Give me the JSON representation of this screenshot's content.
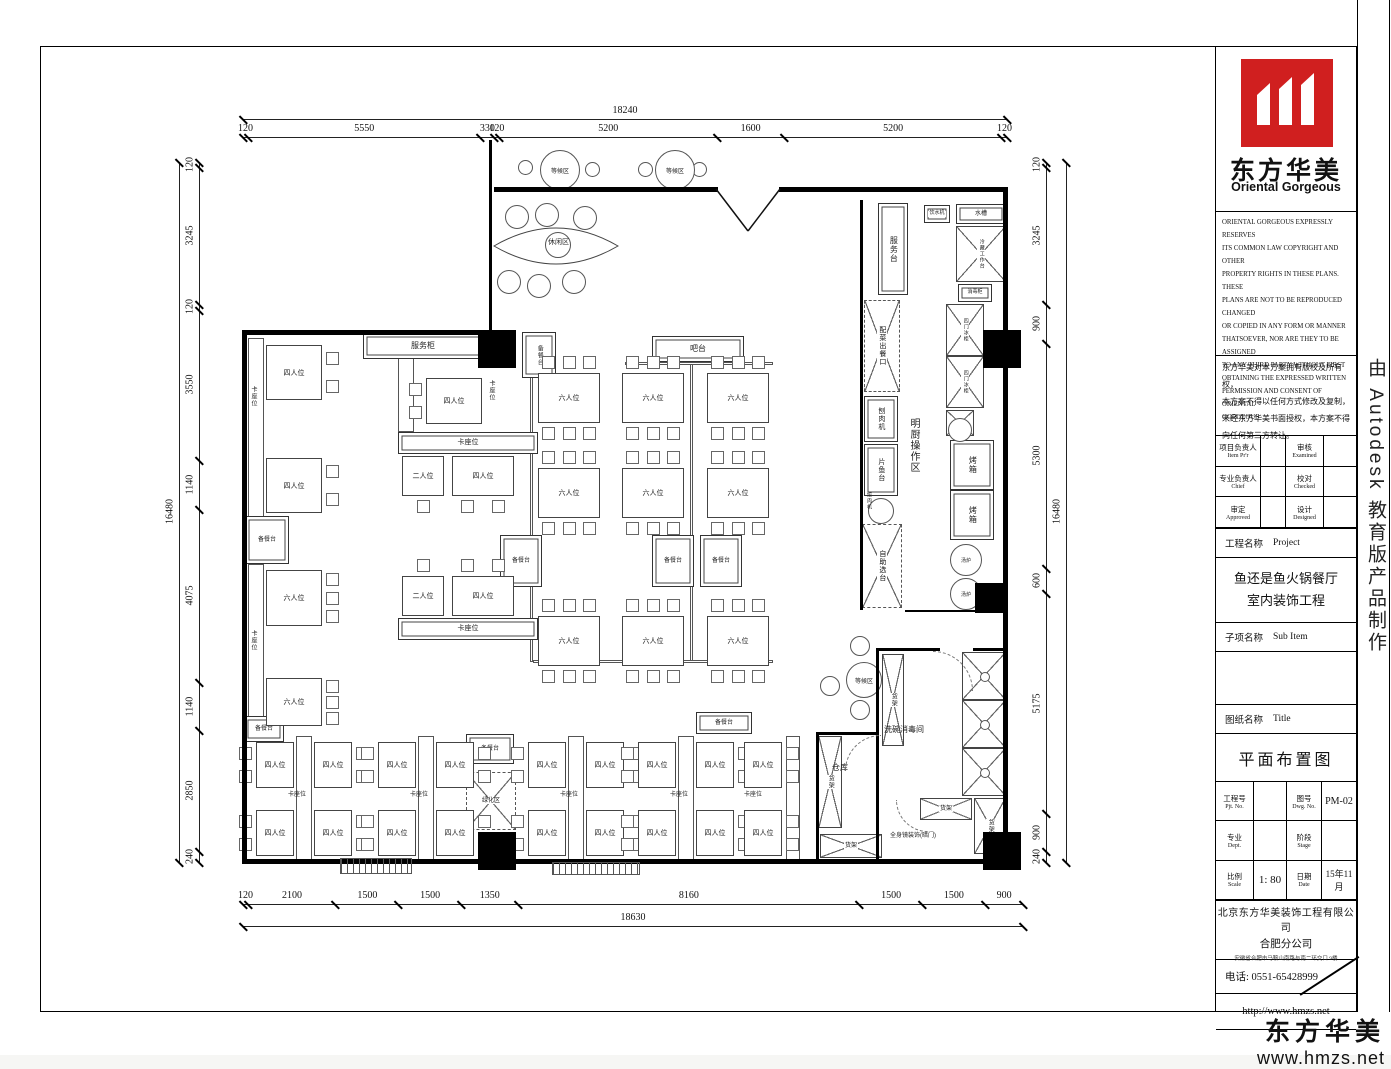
{
  "title_block": {
    "logo_cn": "东方华美",
    "logo_en": "Oriental Gorgeous",
    "copyright_en": "ORIENTAL GORGEOUS EXPRESSLY RESERVES\nITS COMMON LAW COPYRIGHT AND OTHER\nPROPERTY RIGHTS IN THESE PLANS. THESE\nPLANS ARE NOT TO BE REPRODUCED CHANGED\nOR COPIED IN ANY FORM OR MANNER\nTHATSOEVER, NOR ARE THEY TO BE ASSIGNED\nTO ANY THIRD PARTY WITHOUT FIRST\nOBTAINING THE EXPRESSED WRITTEN\nPERMISSION AND CONSENT OF ORIENTAL\nGORGEOUS",
    "copyright_cn": "东方华美对本方案拥有版权及所有权，\n本方案不得以任何方式修改及复制，\n未经东方华美书面授权，本方案不得\n向任何第三方转让。",
    "fields": {
      "item_cn": "项目负责人",
      "item_en": "Item Pr'r",
      "examined_cn": "审核",
      "examined_en": "Examined",
      "chief_cn": "专业负责人",
      "chief_en": "Chief",
      "checked_cn": "校对",
      "checked_en": "Checked",
      "approved_cn": "审定",
      "approved_en": "Approved",
      "designed_cn": "设计",
      "designed_en": "Designed"
    },
    "project_label_cn": "工程名称",
    "project_label_en": "Project",
    "project_name": "鱼还是鱼火锅餐厅\n室内装饰工程",
    "subitem_cn": "子项名称",
    "subitem_en": "Sub Item",
    "sheet_cn": "图纸名称",
    "sheet_en": "Title",
    "drawing_title": "平面布置图",
    "pjt_cn": "工程号",
    "pjt_en": "Pjt. No.",
    "dwg_cn": "图号",
    "dwg_en": "Dwg. No.",
    "dwg_no": "PM-02",
    "dept_cn": "专业",
    "dept_en": "Dept.",
    "stage_cn": "阶段",
    "stage_en": "Stage",
    "scale_cn": "比例",
    "scale_en": "Scale",
    "scale_val": "1: 80",
    "date_cn": "日期",
    "date_en": "Date",
    "date_val": "15年11月",
    "company": "北京东方华美装饰工程有限公司",
    "branch": "合肥分公司",
    "address": "安徽省合肥市马鞍山南路与南二环交口 9楼",
    "phone": "电话: 0551-65428999",
    "website": "http://www.hmzs.net",
    "brand_red": "#d01f1f"
  },
  "side_strip": "由 Autodesk 教育版产品制作",
  "footer": {
    "brand": "东方华美",
    "url": "www.hmzs.net"
  },
  "floorplan": {
    "dims": {
      "top": {
        "total": "18240",
        "values": [
          120,
          5550,
          330,
          120,
          5200,
          1600,
          5200,
          120
        ]
      },
      "bottom": {
        "total": "18630",
        "values": [
          120,
          2100,
          1500,
          1500,
          1350,
          8160,
          1500,
          1500,
          900
        ]
      },
      "left": {
        "total": "16480",
        "values": [
          120,
          3245,
          120,
          3550,
          1140,
          4075,
          1140,
          2850,
          240
        ]
      },
      "right": {
        "total": "16480",
        "values": [
          120,
          3245,
          900,
          5300,
          600,
          5175,
          900,
          240
        ]
      }
    },
    "walls": [
      {
        "x": 242,
        "y": 330,
        "w": 243,
        "h": 5
      },
      {
        "x": 242,
        "y": 330,
        "w": 5,
        "h": 534
      },
      {
        "x": 242,
        "y": 859,
        "w": 766,
        "h": 5
      },
      {
        "x": 1003,
        "y": 187,
        "w": 5,
        "h": 676
      },
      {
        "x": 494,
        "y": 187,
        "w": 224,
        "h": 5
      },
      {
        "x": 779,
        "y": 187,
        "w": 229,
        "h": 5
      },
      {
        "x": 489,
        "y": 140,
        "w": 3,
        "h": 192
      },
      {
        "x": 860,
        "y": 200,
        "w": 3,
        "h": 410
      },
      {
        "x": 876,
        "y": 648,
        "w": 64,
        "h": 3
      },
      {
        "x": 973,
        "y": 648,
        "w": 33,
        "h": 3
      },
      {
        "x": 876,
        "y": 648,
        "w": 3,
        "h": 214
      },
      {
        "x": 816,
        "y": 732,
        "w": 62,
        "h": 3
      },
      {
        "x": 816,
        "y": 732,
        "w": 3,
        "h": 130
      },
      {
        "x": 905,
        "y": 610,
        "w": 100,
        "h": 2
      }
    ],
    "columns": [
      {
        "x": 478,
        "y": 330,
        "s": 38
      },
      {
        "x": 983,
        "y": 330,
        "s": 38
      },
      {
        "x": 975,
        "y": 583,
        "s": 30
      },
      {
        "x": 478,
        "y": 832,
        "s": 38
      },
      {
        "x": 983,
        "y": 832,
        "s": 38
      }
    ],
    "benches": [
      {
        "x": 248,
        "y": 338,
        "w": 16,
        "h": 218
      },
      {
        "x": 248,
        "y": 564,
        "w": 16,
        "h": 166
      },
      {
        "x": 296,
        "y": 736,
        "w": 16,
        "h": 124
      },
      {
        "x": 418,
        "y": 736,
        "w": 16,
        "h": 124
      },
      {
        "x": 568,
        "y": 736,
        "w": 16,
        "h": 124
      },
      {
        "x": 678,
        "y": 736,
        "w": 16,
        "h": 124
      },
      {
        "x": 786,
        "y": 736,
        "w": 14,
        "h": 124
      },
      {
        "x": 398,
        "y": 340,
        "w": 16,
        "h": 92
      },
      {
        "x": 530,
        "y": 362,
        "w": 3,
        "h": 300
      },
      {
        "x": 690,
        "y": 362,
        "w": 3,
        "h": 300
      },
      {
        "x": 625,
        "y": 362,
        "w": 148,
        "h": 3
      },
      {
        "x": 533,
        "y": 660,
        "w": 240,
        "h": 3
      }
    ],
    "tables": [
      {
        "x": 266,
        "y": 345,
        "w": 56,
        "h": 55,
        "c": "r2",
        "l": "四人位"
      },
      {
        "x": 266,
        "y": 458,
        "w": 56,
        "h": 55,
        "c": "r2",
        "l": "四人位"
      },
      {
        "x": 266,
        "y": 570,
        "w": 56,
        "h": 56,
        "c": "r3",
        "l": "六人位"
      },
      {
        "x": 266,
        "y": 678,
        "w": 56,
        "h": 48,
        "c": "r3",
        "l": "六人位"
      },
      {
        "x": 426,
        "y": 378,
        "w": 56,
        "h": 46,
        "c": "l2",
        "l": "四人位"
      },
      {
        "x": 402,
        "y": 456,
        "w": 42,
        "h": 40,
        "c": "b1",
        "l": "二人位"
      },
      {
        "x": 452,
        "y": 456,
        "w": 62,
        "h": 40,
        "c": "b2",
        "l": "四人位"
      },
      {
        "x": 402,
        "y": 576,
        "w": 42,
        "h": 40,
        "c": "t1",
        "l": "二人位"
      },
      {
        "x": 452,
        "y": 576,
        "w": 62,
        "h": 40,
        "c": "t2",
        "l": "四人位"
      },
      {
        "x": 538,
        "y": 373,
        "w": 62,
        "h": 50,
        "c": "t3b3",
        "l": "六人位"
      },
      {
        "x": 622,
        "y": 373,
        "w": 62,
        "h": 50,
        "c": "t3b3",
        "l": "六人位"
      },
      {
        "x": 707,
        "y": 373,
        "w": 62,
        "h": 50,
        "c": "t3b3",
        "l": "六人位"
      },
      {
        "x": 538,
        "y": 468,
        "w": 62,
        "h": 50,
        "c": "t3b3",
        "l": "六人位"
      },
      {
        "x": 622,
        "y": 468,
        "w": 62,
        "h": 50,
        "c": "t3b3",
        "l": "六人位"
      },
      {
        "x": 707,
        "y": 468,
        "w": 62,
        "h": 50,
        "c": "t3b3",
        "l": "六人位"
      },
      {
        "x": 538,
        "y": 616,
        "w": 62,
        "h": 50,
        "c": "t3b3",
        "l": "六人位"
      },
      {
        "x": 622,
        "y": 616,
        "w": 62,
        "h": 50,
        "c": "t3b3",
        "l": "六人位"
      },
      {
        "x": 707,
        "y": 616,
        "w": 62,
        "h": 50,
        "c": "t3b3",
        "l": "六人位"
      },
      {
        "x": 256,
        "y": 742,
        "w": 38,
        "h": 46,
        "c": "l2",
        "l": "四人位"
      },
      {
        "x": 314,
        "y": 742,
        "w": 38,
        "h": 46,
        "c": "r2",
        "l": "四人位"
      },
      {
        "x": 256,
        "y": 810,
        "w": 38,
        "h": 46,
        "c": "l2",
        "l": "四人位"
      },
      {
        "x": 314,
        "y": 810,
        "w": 38,
        "h": 46,
        "c": "r2",
        "l": "四人位"
      },
      {
        "x": 378,
        "y": 742,
        "w": 38,
        "h": 46,
        "c": "l2",
        "l": "四人位"
      },
      {
        "x": 436,
        "y": 742,
        "w": 38,
        "h": 46,
        "c": "r2",
        "l": "四人位"
      },
      {
        "x": 378,
        "y": 810,
        "w": 38,
        "h": 46,
        "c": "l2",
        "l": "四人位"
      },
      {
        "x": 436,
        "y": 810,
        "w": 38,
        "h": 46,
        "c": "r2",
        "l": "四人位"
      },
      {
        "x": 528,
        "y": 742,
        "w": 38,
        "h": 46,
        "c": "l2",
        "l": "四人位"
      },
      {
        "x": 586,
        "y": 742,
        "w": 38,
        "h": 46,
        "c": "r2",
        "l": "四人位"
      },
      {
        "x": 528,
        "y": 810,
        "w": 38,
        "h": 46,
        "c": "l2",
        "l": "四人位"
      },
      {
        "x": 586,
        "y": 810,
        "w": 38,
        "h": 46,
        "c": "r2",
        "l": "四人位"
      },
      {
        "x": 638,
        "y": 742,
        "w": 38,
        "h": 46,
        "c": "l2",
        "l": "四人位"
      },
      {
        "x": 696,
        "y": 742,
        "w": 38,
        "h": 46,
        "c": "r2",
        "l": "四人位"
      },
      {
        "x": 638,
        "y": 810,
        "w": 38,
        "h": 46,
        "c": "l2",
        "l": "四人位"
      },
      {
        "x": 696,
        "y": 810,
        "w": 38,
        "h": 46,
        "c": "r2",
        "l": "四人位"
      },
      {
        "x": 744,
        "y": 742,
        "w": 38,
        "h": 46,
        "c": "r2",
        "l": "四人位"
      },
      {
        "x": 744,
        "y": 810,
        "w": 38,
        "h": 46,
        "c": "r2",
        "l": "四人位"
      }
    ],
    "counters": [
      {
        "x": 363,
        "y": 333,
        "w": 120,
        "h": 26,
        "l": "服务柜",
        "fs": 8
      },
      {
        "x": 652,
        "y": 336,
        "w": 92,
        "h": 26,
        "l": "吧台",
        "fs": 8
      },
      {
        "x": 522,
        "y": 332,
        "w": 34,
        "h": 46,
        "l": "备餐台",
        "r": 1,
        "fs": 6
      },
      {
        "x": 245,
        "y": 516,
        "w": 44,
        "h": 48,
        "l": "备餐台",
        "fs": 6
      },
      {
        "x": 244,
        "y": 716,
        "w": 40,
        "h": 26,
        "l": "备餐台",
        "fs": 6
      },
      {
        "x": 500,
        "y": 535,
        "w": 42,
        "h": 52,
        "l": "备餐台",
        "fs": 6
      },
      {
        "x": 652,
        "y": 535,
        "w": 42,
        "h": 52,
        "l": "备餐台",
        "fs": 6
      },
      {
        "x": 700,
        "y": 535,
        "w": 42,
        "h": 52,
        "l": "备餐台",
        "fs": 6
      },
      {
        "x": 398,
        "y": 432,
        "w": 140,
        "h": 22,
        "l": "卡座位",
        "fs": 7
      },
      {
        "x": 398,
        "y": 618,
        "w": 140,
        "h": 22,
        "l": "卡座位",
        "fs": 7
      },
      {
        "x": 466,
        "y": 734,
        "w": 48,
        "h": 30,
        "l": "备餐台",
        "fs": 6
      },
      {
        "x": 696,
        "y": 712,
        "w": 56,
        "h": 22,
        "l": "备餐台",
        "fs": 6
      },
      {
        "x": 878,
        "y": 203,
        "w": 30,
        "h": 92,
        "l": "服务台",
        "r": 1,
        "fs": 8
      },
      {
        "x": 864,
        "y": 396,
        "w": 34,
        "h": 46,
        "l": "刨肉机",
        "r": 1,
        "fs": 7
      },
      {
        "x": 864,
        "y": 444,
        "w": 34,
        "h": 52,
        "l": "片鱼台",
        "r": 1,
        "fs": 7
      },
      {
        "x": 924,
        "y": 205,
        "w": 26,
        "h": 18,
        "l": "饮水机",
        "fs": 5
      },
      {
        "x": 956,
        "y": 204,
        "w": 50,
        "h": 20,
        "l": "水槽",
        "fs": 6
      },
      {
        "x": 958,
        "y": 284,
        "w": 34,
        "h": 18,
        "l": "消毒柜",
        "fs": 5
      },
      {
        "x": 950,
        "y": 440,
        "w": 44,
        "h": 50,
        "l": "烤箱",
        "r": 1,
        "fs": 8
      },
      {
        "x": 950,
        "y": 490,
        "w": 44,
        "h": 50,
        "l": "烤箱",
        "r": 1,
        "fs": 8
      }
    ],
    "dashx": [
      {
        "x": 864,
        "y": 300,
        "w": 36,
        "h": 92,
        "l": "配菜出餐口",
        "r": 1,
        "fs": 7
      },
      {
        "x": 862,
        "y": 524,
        "w": 40,
        "h": 84,
        "l": "自助选台",
        "r": 1,
        "fs": 7
      }
    ],
    "xboxes": [
      {
        "x": 956,
        "y": 226,
        "w": 50,
        "h": 56,
        "l": "冷藏工作台",
        "r": 1,
        "fs": 5
      },
      {
        "x": 946,
        "y": 304,
        "w": 38,
        "h": 52,
        "l": "四门冰柜",
        "r": 1,
        "fs": 5
      },
      {
        "x": 946,
        "y": 356,
        "w": 38,
        "h": 52,
        "l": "四门冰柜",
        "r": 1,
        "fs": 5
      },
      {
        "x": 946,
        "y": 410,
        "w": 28,
        "h": 26
      },
      {
        "x": 882,
        "y": 654,
        "w": 22,
        "h": 92,
        "l": "货架",
        "r": 1,
        "fs": 6
      },
      {
        "x": 962,
        "y": 652,
        "w": 44,
        "h": 48,
        "sink": 1
      },
      {
        "x": 962,
        "y": 700,
        "w": 44,
        "h": 48,
        "sink": 1
      },
      {
        "x": 962,
        "y": 748,
        "w": 44,
        "h": 48,
        "sink": 1
      },
      {
        "x": 974,
        "y": 798,
        "w": 32,
        "h": 56,
        "l": "货架",
        "r": 1,
        "fs": 6
      },
      {
        "x": 920,
        "y": 798,
        "w": 52,
        "h": 22,
        "l": "货架",
        "fs": 6
      },
      {
        "x": 818,
        "y": 736,
        "w": 24,
        "h": 92,
        "l": "货架",
        "r": 1,
        "fs": 6
      },
      {
        "x": 820,
        "y": 834,
        "w": 62,
        "h": 24,
        "l": "货架",
        "fs": 6
      },
      {
        "x": 466,
        "y": 772,
        "w": 50,
        "h": 58,
        "l": "绿化区",
        "dash": 1,
        "fs": 6
      }
    ],
    "circles": [
      {
        "x": 518,
        "y": 160,
        "d": 15
      },
      {
        "x": 585,
        "y": 162,
        "d": 15
      },
      {
        "x": 638,
        "y": 162,
        "d": 15
      },
      {
        "x": 692,
        "y": 162,
        "d": 15
      },
      {
        "x": 540,
        "y": 150,
        "d": 40,
        "l": "等候区",
        "fs": 6
      },
      {
        "x": 655,
        "y": 150,
        "d": 40,
        "l": "等候区",
        "fs": 6
      },
      {
        "x": 505,
        "y": 205,
        "d": 24
      },
      {
        "x": 535,
        "y": 203,
        "d": 24
      },
      {
        "x": 573,
        "y": 206,
        "d": 24
      },
      {
        "x": 545,
        "y": 232,
        "d": 26
      },
      {
        "x": 497,
        "y": 270,
        "d": 24
      },
      {
        "x": 527,
        "y": 274,
        "d": 24
      },
      {
        "x": 562,
        "y": 270,
        "d": 24
      },
      {
        "x": 846,
        "y": 662,
        "d": 36,
        "l": "等候区",
        "fs": 6
      },
      {
        "x": 850,
        "y": 636,
        "d": 20
      },
      {
        "x": 820,
        "y": 676,
        "d": 20
      },
      {
        "x": 850,
        "y": 700,
        "d": 20
      },
      {
        "x": 868,
        "y": 498,
        "d": 26,
        "xc": 1
      },
      {
        "x": 948,
        "y": 418,
        "d": 24,
        "xc": 1
      },
      {
        "x": 950,
        "y": 544,
        "d": 32,
        "l": "汤炉",
        "fs": 5
      },
      {
        "x": 950,
        "y": 578,
        "d": 32,
        "l": "汤炉",
        "fs": 5
      }
    ],
    "texts": [
      {
        "x": 906,
        "y": 418,
        "l": "明厨操作区",
        "r": 1,
        "fs": 10
      },
      {
        "x": 884,
        "y": 724,
        "l": "洗碗消毒间",
        "fs": 8
      },
      {
        "x": 832,
        "y": 762,
        "l": "仓库",
        "fs": 8
      },
      {
        "x": 890,
        "y": 830,
        "l": "全身镜装饰(暗门)",
        "fs": 6
      },
      {
        "x": 548,
        "y": 237,
        "l": "休闲区",
        "fs": 7
      },
      {
        "x": 249,
        "y": 386,
        "l": "卡座位",
        "r": 1,
        "fs": 6
      },
      {
        "x": 249,
        "y": 630,
        "l": "卡座位",
        "r": 1,
        "fs": 6
      },
      {
        "x": 487,
        "y": 380,
        "l": "卡座位",
        "r": 1,
        "fs": 6
      },
      {
        "x": 288,
        "y": 789,
        "l": "卡座位",
        "fs": 6
      },
      {
        "x": 410,
        "y": 789,
        "l": "卡座位",
        "fs": 6
      },
      {
        "x": 560,
        "y": 789,
        "l": "卡座位",
        "fs": 6
      },
      {
        "x": 670,
        "y": 789,
        "l": "卡座位",
        "fs": 6
      },
      {
        "x": 744,
        "y": 789,
        "l": "卡座位",
        "fs": 6
      },
      {
        "x": 866,
        "y": 492,
        "l": "绞肉机",
        "r": 1,
        "fs": 5
      }
    ],
    "hatches": [
      {
        "x": 340,
        "y": 858,
        "w": 72,
        "h": 16
      },
      {
        "x": 552,
        "y": 862,
        "w": 88,
        "h": 13
      }
    ],
    "arcs": [
      {
        "x": 933,
        "y": 651,
        "r": 40,
        "t": "tr"
      },
      {
        "x": 845,
        "y": 735,
        "r": 36,
        "t": "tl"
      },
      {
        "x": 896,
        "y": 800,
        "r": 32,
        "t": "bl"
      }
    ]
  }
}
